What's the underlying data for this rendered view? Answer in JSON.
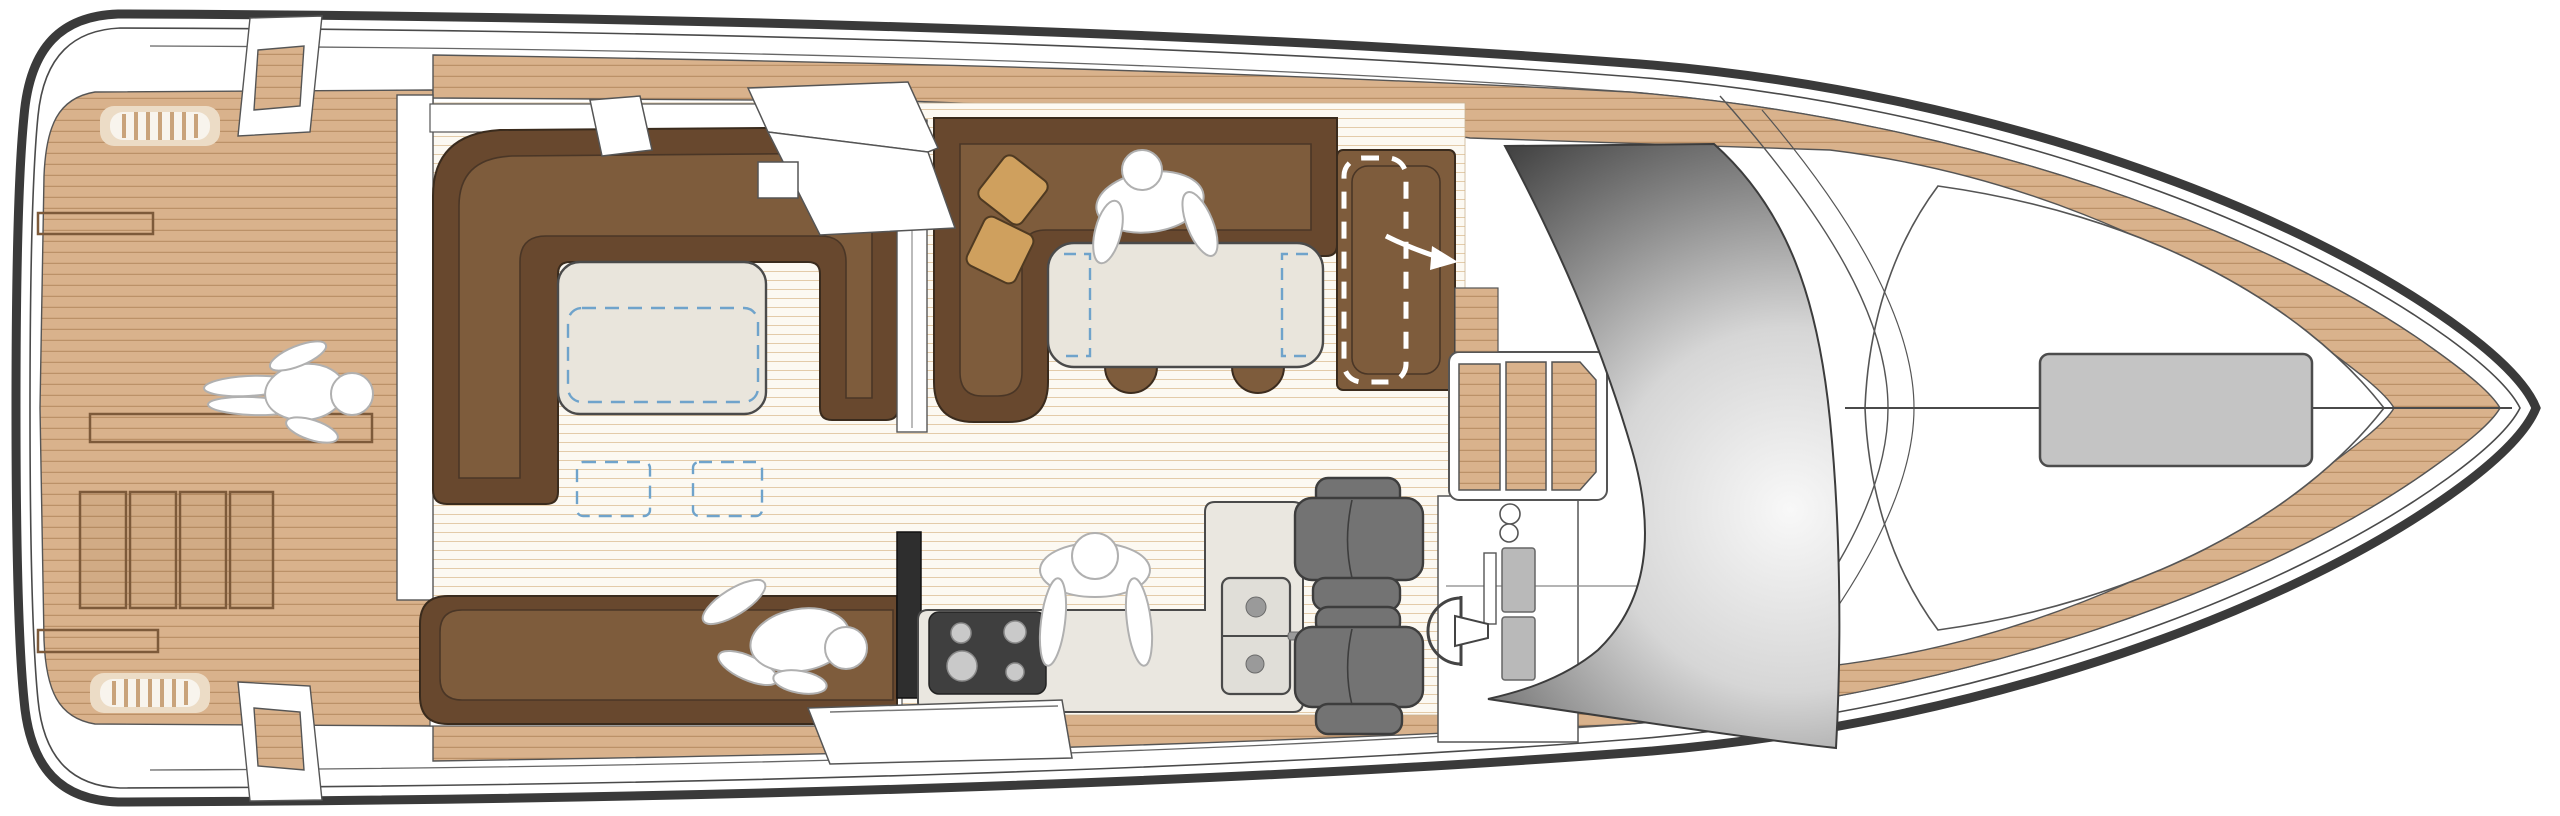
{
  "diagram": {
    "title": "motor-yacht-main-deck-floor-plan",
    "type": "boat-deck-plan-top-view",
    "orientation": {
      "bow": "right",
      "stern": "left"
    },
    "zones": [
      {
        "id": "aft-deck",
        "label": "aft teak deck with engine hatches and deck vents"
      },
      {
        "id": "cockpit",
        "label": "cockpit with U-settee and folding table"
      },
      {
        "id": "salon",
        "label": "salon with L-settee, dining table and pillows"
      },
      {
        "id": "galley",
        "label": "galley with cooktop and drawer unit"
      },
      {
        "id": "helm",
        "label": "helm station with double seats, console and wheel"
      },
      {
        "id": "companionway",
        "label": "companionway steps down"
      },
      {
        "id": "windshield",
        "label": "curved wrap-around windshield"
      },
      {
        "id": "foredeck",
        "label": "foredeck with sunpad and centerline"
      }
    ],
    "figures": [
      {
        "id": "person-aft-deck",
        "pose": "standing on aft deck"
      },
      {
        "id": "person-dinette",
        "pose": "seated at dining table"
      },
      {
        "id": "person-sofa",
        "pose": "seated on salon sofa"
      },
      {
        "id": "person-galley",
        "pose": "standing at galley counter"
      }
    ],
    "colors": {
      "hull_outline": "#3a3a3a",
      "line_gray": "#555555",
      "teak_base": "#d9b28c",
      "teak_line": "#bb9168",
      "floor_base": "#fcf9f2",
      "floor_line": "#e3cba9",
      "seat_brown": "#7e5c3c",
      "seat_brown_dark": "#68482e",
      "seat_edge": "#3a2b1d",
      "pillow_tan": "#cfa05e",
      "table_cream": "#e9e5dc",
      "counter_cream": "#eae7e0",
      "helm_seat_gray": "#737373",
      "helm_seat_edge": "#3d3d3d",
      "stove_black": "#3f3f3f",
      "burner_gray": "#c9c9c9",
      "sunpad_gray": "#c4c4c4",
      "door_track_black": "#2e2e2e",
      "dashed_blue": "#6fa3cb",
      "dashed_white": "#ffffff",
      "figure_white": "#ffffff",
      "figure_edge": "#b0b0b0",
      "wind_light": "#f8f8f8",
      "wind_mid": "#8f8f8f",
      "wind_dark": "#262626"
    }
  }
}
